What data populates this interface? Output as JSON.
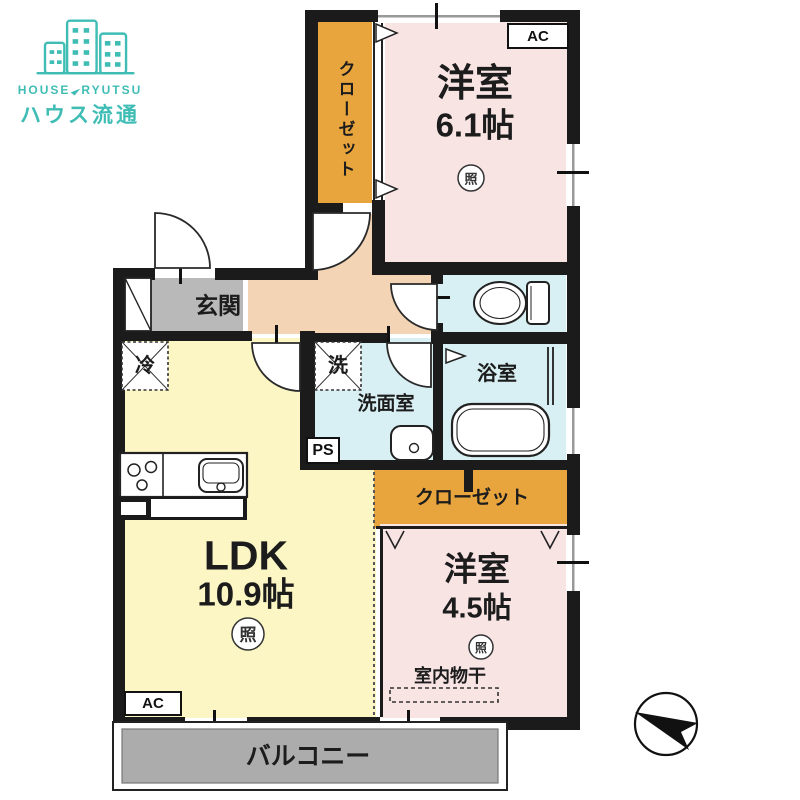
{
  "logo": {
    "en_left": "HOUSE",
    "en_right": "RYUTSU",
    "jp": "ハウス流通"
  },
  "colors": {
    "brand_teal": "#3FBDB5",
    "wall": "#1b1b1b",
    "room_pink": "#F9E4E4",
    "closet_orange": "#E8A53E",
    "ldk_yellow": "#FBF6C4",
    "hall_peach": "#F3D5B5",
    "wet_cyan": "#D8F0F3",
    "entry_gray": "#B9B9B9",
    "balcony_gray": "#ACACAC"
  },
  "rooms": {
    "western1_name": "洋室",
    "western1_size": "6.1帖",
    "ldk_name": "LDK",
    "ldk_size": "10.9帖",
    "western2_name": "洋室",
    "western2_size": "4.5帖",
    "entrance": "玄関",
    "washroom": "洗面室",
    "bathroom": "浴室",
    "closet_vertical": "クローゼット",
    "closet_horizontal": "クローゼット",
    "balcony": "バルコニー",
    "indoor_laundry": "室内物干"
  },
  "markers": {
    "ac": "AC",
    "ps": "PS",
    "light": "照",
    "refrigerator": "冷",
    "washer": "洗"
  }
}
